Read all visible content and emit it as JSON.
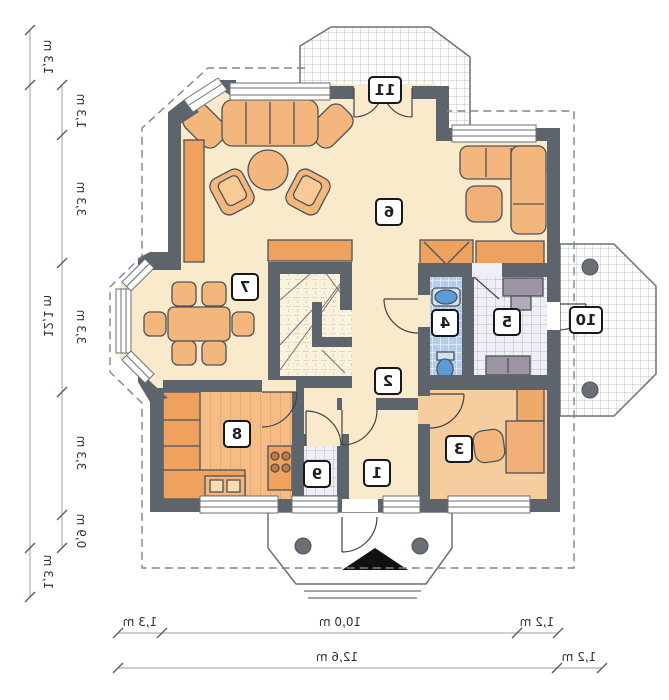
{
  "plan": {
    "type": "floor-plan-mirrored",
    "rooms": [
      "1",
      "2",
      "3",
      "4",
      "5",
      "6",
      "7",
      "8",
      "9",
      "10",
      "11"
    ],
    "unit": "m",
    "dimensions": {
      "left_outer": [
        "1,3 m",
        "12,1 m",
        "1,3 m"
      ],
      "left_inner": [
        "1,3 m",
        "3,3 m",
        "3,3 m",
        "3,3 m",
        "0,9 m"
      ],
      "bottom_upper": [
        "1,3 m",
        "10,0 m",
        "1,2 m"
      ],
      "bottom_lower": [
        "12,6 m",
        "1,2 m"
      ]
    },
    "colors": {
      "wall": "#5d646c",
      "floor_cream": "#faeacc",
      "floor_kitchen": "#f5bd85",
      "floor_room3": "#f5cd9e",
      "floor_tile_blue": "#b5cde9",
      "floor_tile_gray": "#eef0f6",
      "furniture_orange": "#f3b77d",
      "counter_orange": "#efa25e",
      "fixture_blue": "#5b9bd8",
      "furniture_gray": "#9d94a5",
      "roof_dash": "#7f858c",
      "dim_line": "#9aa0a7"
    }
  }
}
